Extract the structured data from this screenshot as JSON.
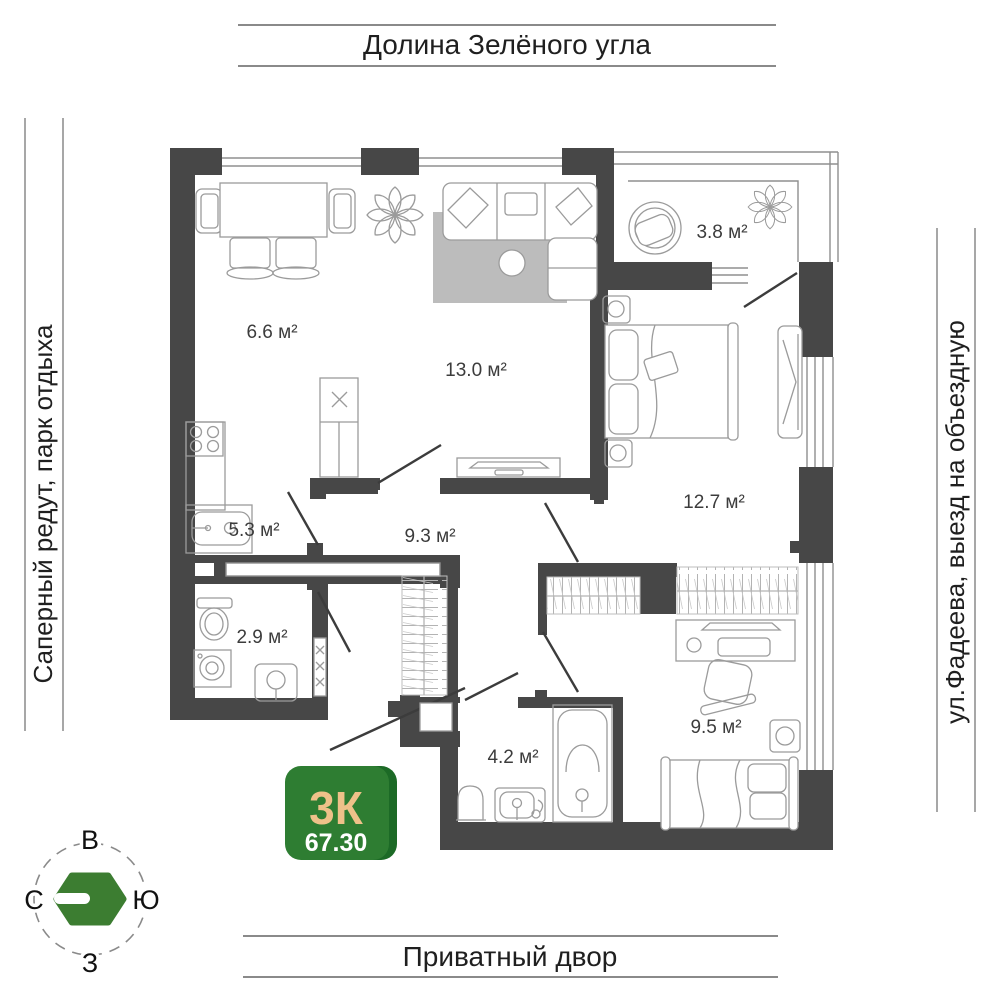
{
  "banners": {
    "top": "Долина Зелёного угла",
    "bottom": "Приватный двор",
    "left": "Саперный редут, парк отдыха",
    "right": "ул.Фадеева, выезд на объездную"
  },
  "compass": {
    "top": "В",
    "left": "С",
    "right": "Ю",
    "bottom": "З"
  },
  "badge": {
    "rooms": "3К",
    "area": "67.30"
  },
  "plan": {
    "rooms": [
      {
        "name": "kitchen-dining",
        "label": "6.6 м²"
      },
      {
        "name": "living-room",
        "label": "13.0 м²"
      },
      {
        "name": "balcony",
        "label": "3.8 м²"
      },
      {
        "name": "bedroom",
        "label": "12.7 м²"
      },
      {
        "name": "kitchen-work",
        "label": "5.3 м²"
      },
      {
        "name": "hallway",
        "label": "9.3 м²"
      },
      {
        "name": "bathroom-small",
        "label": "2.9 м²"
      },
      {
        "name": "bathroom",
        "label": "4.2 м²"
      },
      {
        "name": "bedroom-small",
        "label": "9.5 м²"
      }
    ]
  },
  "colors": {
    "wall": "#474747",
    "badge_green": "#2e7d32",
    "badge_green_dark": "#1c6a26",
    "badge_accent": "#eec189",
    "logo_green": "#3c7d31"
  }
}
